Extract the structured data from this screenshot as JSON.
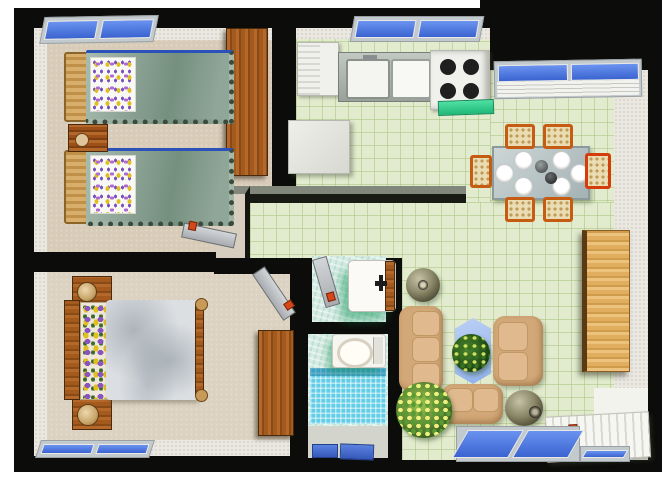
{
  "title": "Apartment floor plan — 3D top-down view",
  "palette": {
    "wall": "#0c0c0a",
    "bedroom_floor": "#d8ccb8",
    "tile_floor": "#e2ebcd",
    "bathroom_tile": "#d6ebe3",
    "shower_tile": "#62cde6",
    "window_glass": "#4b7ae6",
    "wood": "#a55a1d",
    "sofa_leather": "#d2a878",
    "bed_cover": "#8aa193",
    "stove_mat": "#2ecf8f",
    "chair_frame": "#c65c12"
  },
  "rooms": [
    {
      "name": "Twin bedroom",
      "furniture": [
        "twin bed",
        "twin bed",
        "nightstand",
        "wardrobe",
        "window",
        "door"
      ]
    },
    {
      "name": "Master bedroom",
      "furniture": [
        "double bed",
        "nightstand with lamp",
        "nightstand with lamp",
        "dresser",
        "window",
        "door"
      ]
    },
    {
      "name": "Kitchen",
      "furniture": [
        "refrigerator",
        "double-basin sink counter",
        "stove with 4 burners",
        "green floor mat",
        "island counter",
        "window"
      ]
    },
    {
      "name": "Dining area",
      "furniture": [
        "dining table with 6 plates",
        "6 wicker chairs",
        "louvered window"
      ]
    },
    {
      "name": "Living room",
      "furniture": [
        "three-seat sofa",
        "loveseat",
        "two-seat sofa",
        "glass coffee table",
        "houseplant",
        "large potted plant",
        "round vase",
        "jug vase",
        "rattan shelf unit",
        "ribbed rug",
        "floor windows"
      ]
    },
    {
      "name": "Bathroom",
      "furniture": [
        "washbasin with wood trim",
        "toilet",
        "mosaic shower",
        "two bath mats",
        "door"
      ]
    }
  ],
  "counts": {
    "bedrooms": 2,
    "beds": 3,
    "dining_chairs": 6,
    "plates": 6,
    "stove_burners": 4,
    "sofas": 3,
    "windows": 6,
    "doors": 3
  }
}
